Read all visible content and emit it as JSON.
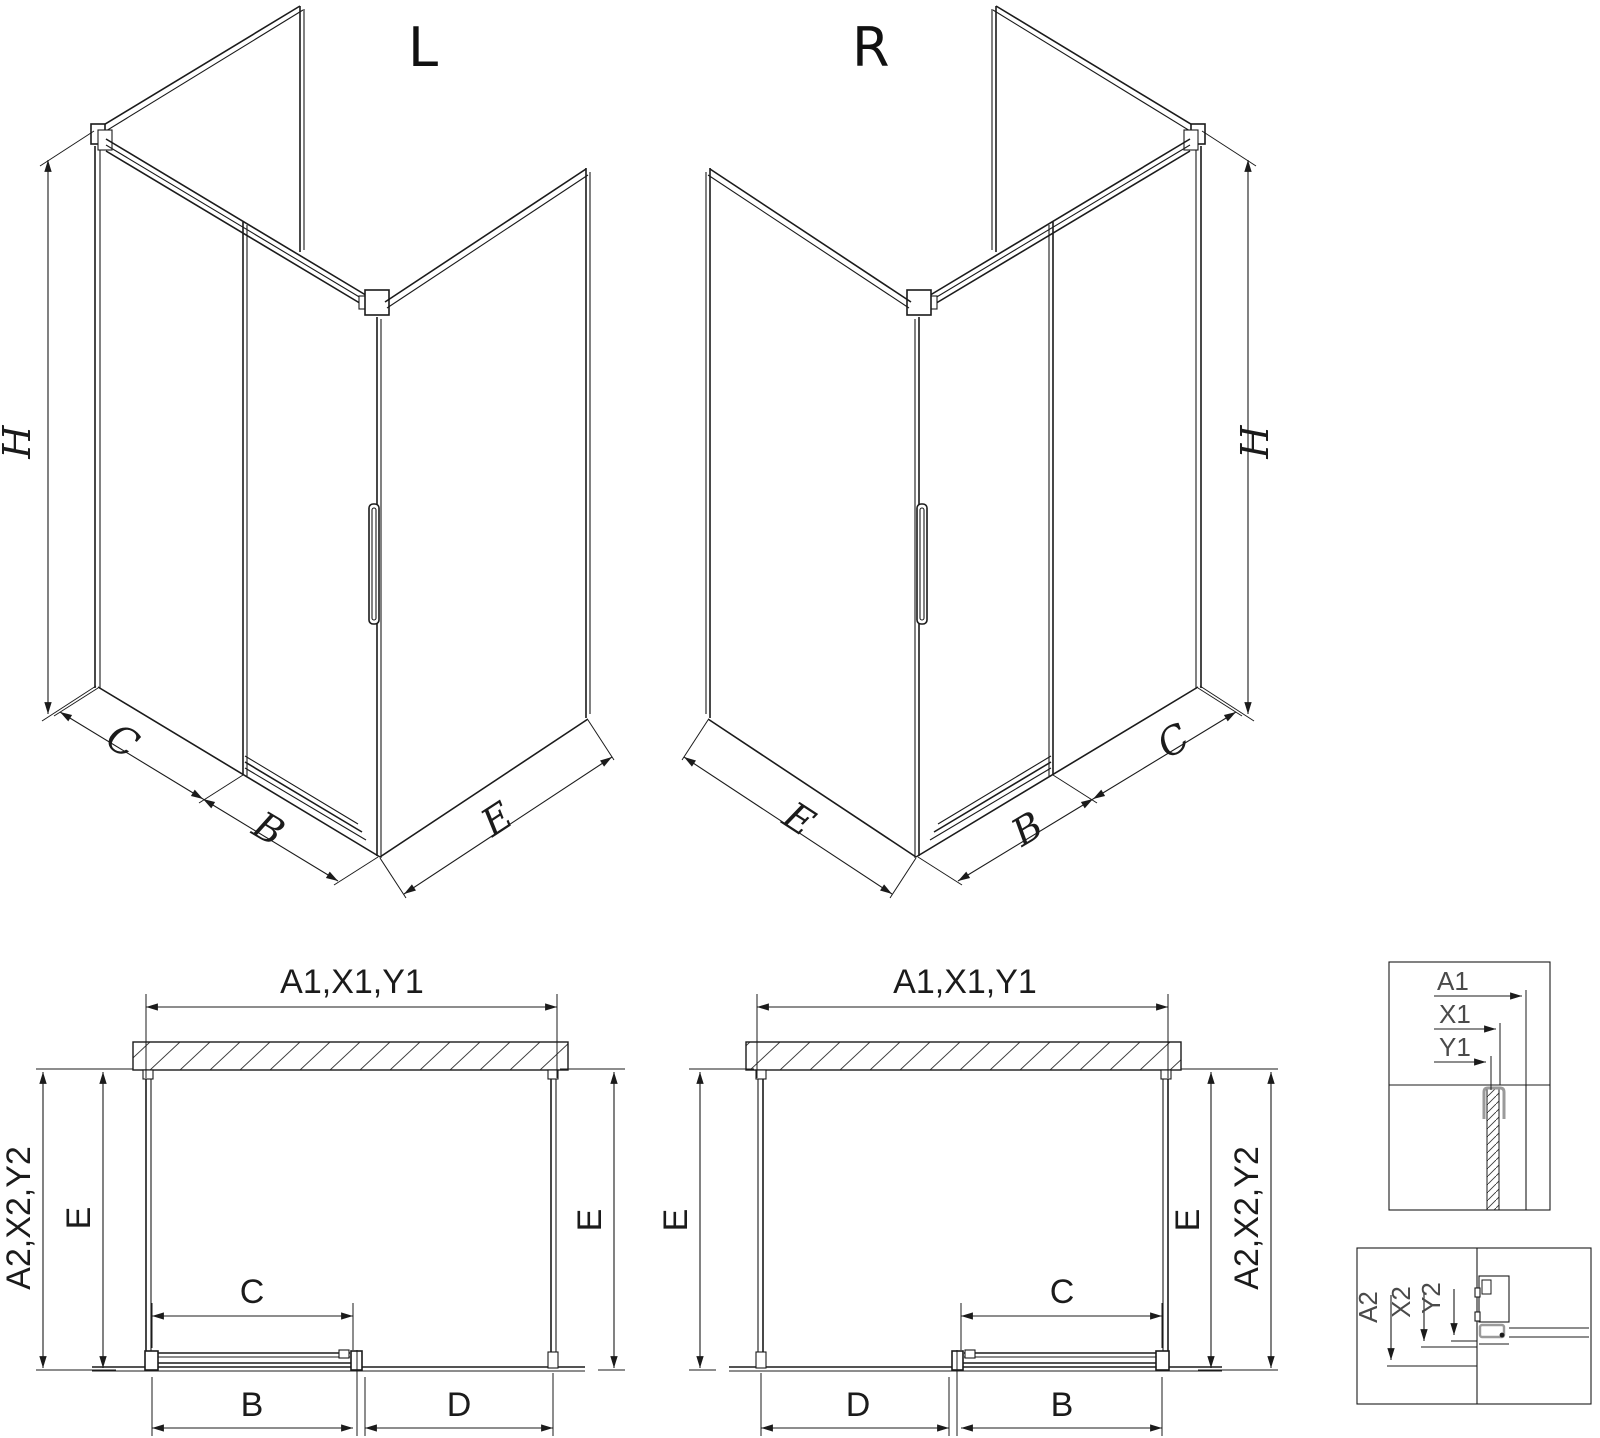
{
  "drawing": {
    "type_labels": {
      "left": "L",
      "right": "R"
    },
    "iso": {
      "height": "H",
      "fixed_panel": "C",
      "door": "B",
      "side_panel": "E"
    },
    "plan": {
      "top": "A1,X1,Y1",
      "side_outer": "A2,X2,Y2",
      "side_inner": "E",
      "door_opening": "C",
      "door_rail": "B",
      "fixed_segment": "D"
    },
    "detail_wall_labels": [
      "A1",
      "X1",
      "Y1"
    ],
    "detail_floor_labels": [
      "A2",
      "X2",
      "Y2"
    ]
  },
  "colors": {
    "line": "#1b1b1b",
    "detail_text": "#4a4a4a",
    "profile_gray": "#9a9a9a",
    "background": "#ffffff"
  }
}
